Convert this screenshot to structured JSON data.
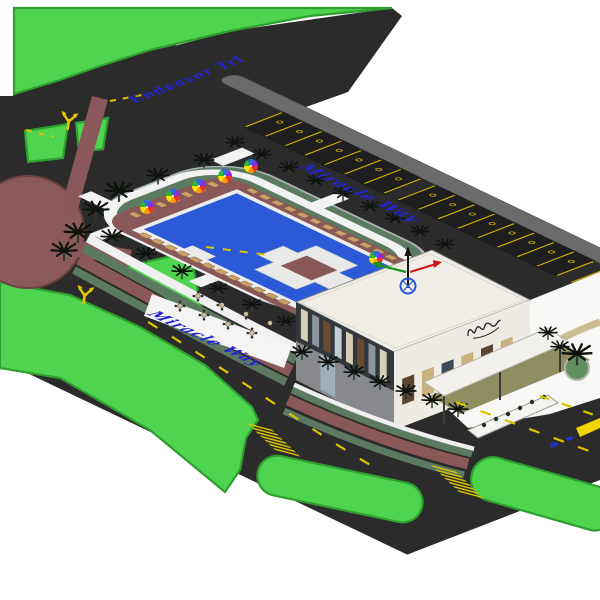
{
  "scene": {
    "description": "Axonometric 3D site-plan render of a pool resort clubhouse with roads, roundabout and parking",
    "background": "#ffffff"
  },
  "colors": {
    "asphalt": "#2b2b2b",
    "grass": "#4fd44f",
    "grass_edge": "#2f9f2f",
    "lawn": "#5c7a62",
    "pool": "#2b59d8",
    "deck": "#8a5858",
    "roundabout": "#8a5a5a",
    "sidewalk": "#6b6b6b",
    "marking": "#d9c400",
    "street_label": "#2323cf",
    "building_roof": "#f1eee8",
    "building_dark_wall": "#33383d",
    "building_accent_wall": "#eeebe4",
    "umbrella": [
      "#e8312a",
      "#ff9a00",
      "#ffe100",
      "#2db52d",
      "#2a6be0",
      "#8a2be2"
    ]
  },
  "streets": {
    "entry_road_label": "Endeavor Trl",
    "north_road_label": "Miracle Way",
    "south_road_label": "Miracle Way"
  },
  "site": {
    "parking_stall_groups": [
      7,
      8,
      5
    ],
    "crosswalks": 2,
    "umbrellas": 6,
    "sun_loungers": 31,
    "palm_trees": 30,
    "dining_tables": 8
  }
}
